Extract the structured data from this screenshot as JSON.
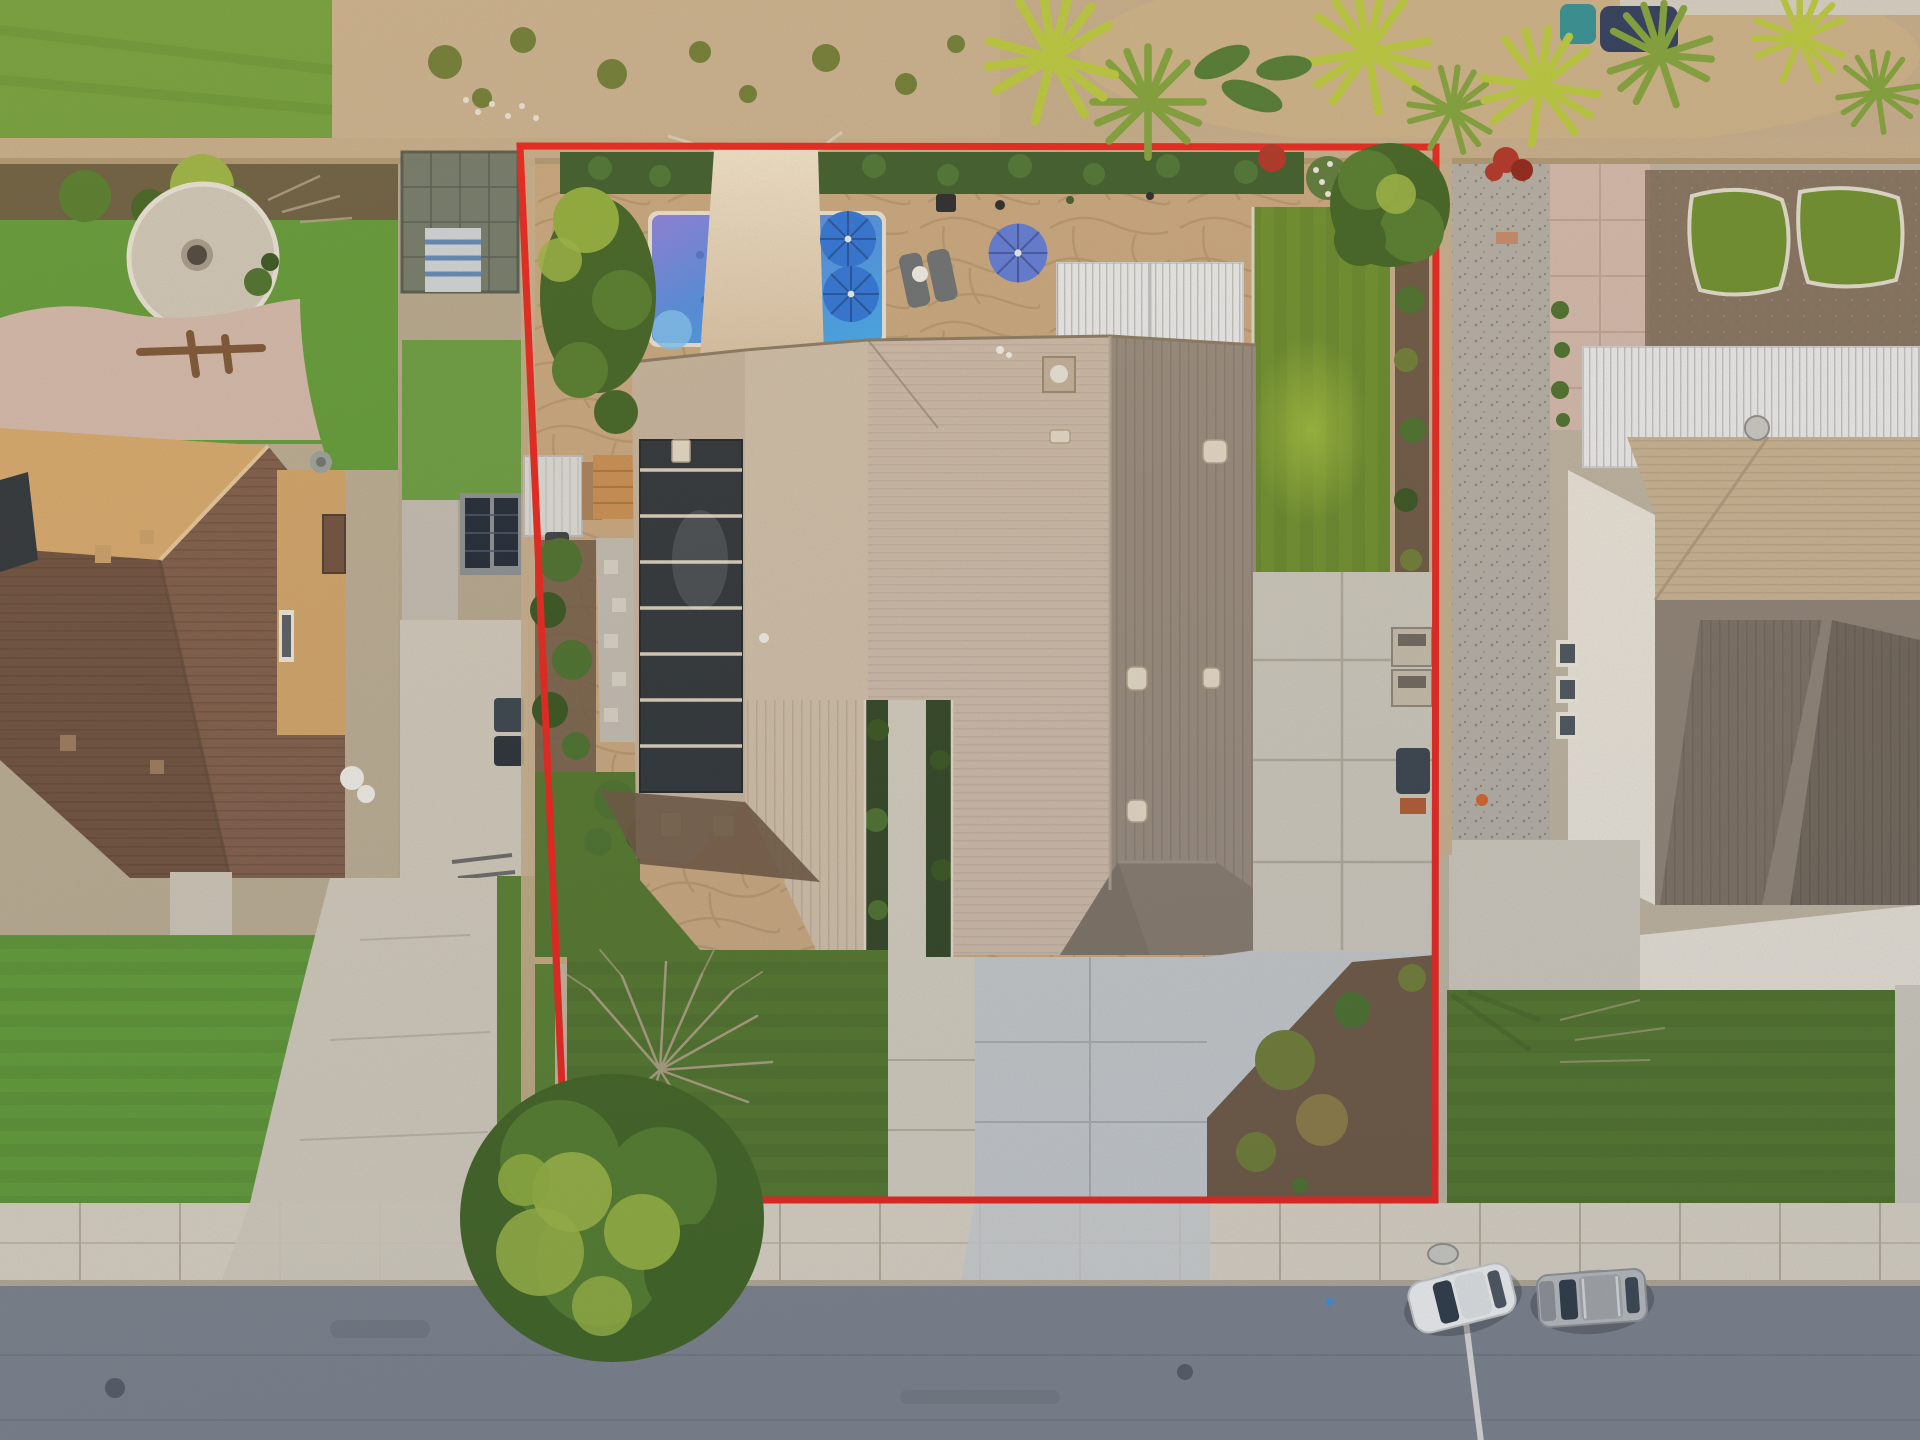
{
  "scene": {
    "type": "aerial-drone-photograph",
    "view": "top-down, dusk light",
    "subject": "single-family house with backyard pool, solar panels, shade sail, white louvered pergola, front driveway and street parking",
    "overlay": {
      "name": "lot-boundary",
      "shape": "rectangle",
      "color": "#e8231c",
      "stroke_px": 7
    },
    "object_counts": {
      "blue-umbrellas": 3,
      "teal-striped-umbrella": 1,
      "pool": 1,
      "shade-sail": 1,
      "pergolas": 2,
      "parked-vehicles": 2,
      "street-light": 1,
      "fire-pit": 1,
      "trash-bins": 4,
      "lounge-chairs": 2
    },
    "vehicles": [
      {
        "kind": "coupe",
        "color": "white",
        "position": "curbside-left"
      },
      {
        "kind": "suv",
        "color": "silver-gray",
        "position": "curbside-right"
      }
    ]
  },
  "palette": {
    "boundary": "#e8231c",
    "street": "#7b828c",
    "sidewalk": "#d8d1c3",
    "curb": "#b2a996",
    "dirt": "#c9b190",
    "meadow": "#70a03c",
    "wall": "#c6ae8c",
    "wall-shadow": "#9a865f",
    "hedge": "#3b5c2b",
    "hedge-light": "#4e7a36",
    "patio": "#c8a77f",
    "patio-line": "#a8875f",
    "pool-purple": "#8b7fe0",
    "pool-mid": "#4f8ee2",
    "pool-cyan": "#3fa9ef",
    "pool-edge": "#e9e2d2",
    "sail": "#f0e3cb",
    "sail-dark": "#d9c3a6",
    "umb-blue": "#2b74da",
    "umb-peri": "#5d7bda",
    "umb-teal": "#45bfae",
    "pergola": "#ebecec",
    "turf": "#6c8f2c",
    "turf-hi": "#a9c63f",
    "front-lawn": "#51762c",
    "neighbor-lawn": "#5f9b37",
    "roof-light": "#c6b49e",
    "roof-mid": "#cfbfa9",
    "roof-pink": "#ccbaa9",
    "roof-dark": "#968a7d",
    "roof-darker": "#84796d",
    "roof-edge": "#8a7a62",
    "solar": "#2c3339",
    "solar-gap": "#d8cfbd",
    "shed": "#dcdcd8",
    "gravel-path": "#c2bcb2",
    "mulch": "#6b5743",
    "bush": "#49702d",
    "bush-dark": "#35541f",
    "bush-olive": "#6d7c35",
    "dead-tree": "#b7a48e",
    "tree-yellow": "#9ab544",
    "tree-green": "#527c2c",
    "tree-dark": "#3f6323",
    "palm-bright": "#b8c93e",
    "palm-dark": "#7fa23a",
    "banana": "#4e7a33",
    "red-bush": "#b03226",
    "gravel": "#b4afa7",
    "slab": "#ccc8bd",
    "driveway": "#c3c8cb",
    "walkway": "#d2cdbf",
    "neighbor-drive": "#d0cabc",
    "nb-roof-light": "#d6a96c",
    "nb-roof-dark": "#7e5c49",
    "nb-roof-darker": "#6d4f3e",
    "nb-wall": "#d0a468",
    "tile-patio": "#d3b9ac",
    "white-roof": "#e9e4da",
    "nb-tan": "#c8b292",
    "nb-dark": "#7a6f63",
    "car-white": "#eff1f1",
    "car-glass": "#2e3a46",
    "suv": "#b7bbbe",
    "bin": "#37424d",
    "ac": "#c6bcab"
  }
}
